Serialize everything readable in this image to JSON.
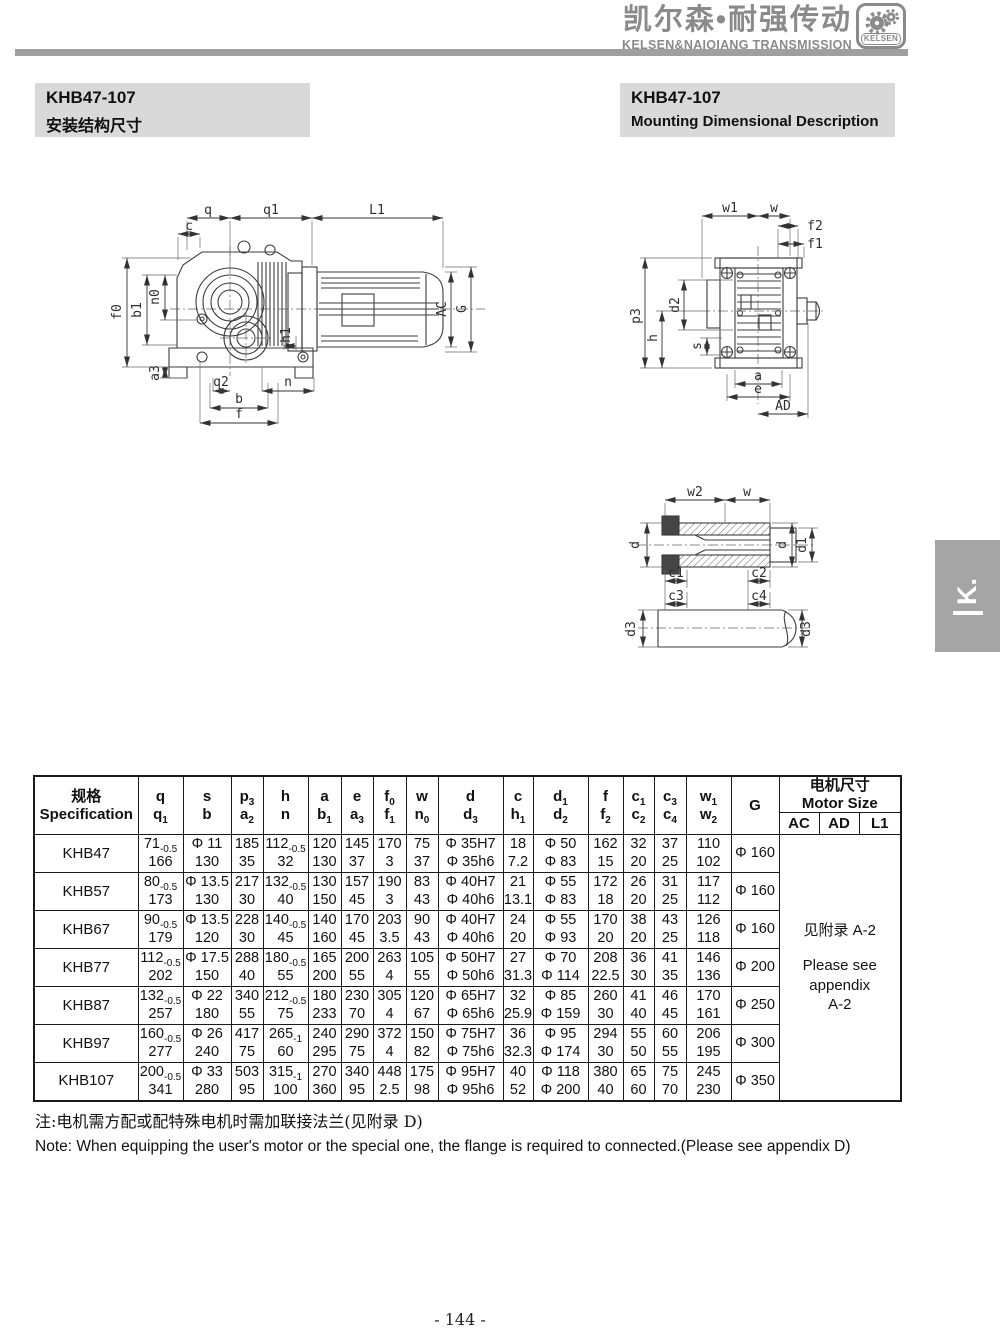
{
  "header": {
    "brand_cn": "凯尔森•耐强传动",
    "brand_en": "KELSEN&NAIQIANG TRANSMISSION",
    "logo_text": "KELSEN"
  },
  "title_left": {
    "model": "KHB47-107",
    "subtitle": "安装结构尺寸"
  },
  "title_right": {
    "model": "KHB47-107",
    "subtitle": "Mounting Dimensional Description"
  },
  "side_tab": {
    "label": "K."
  },
  "drawings": {
    "side_view": {
      "labels": {
        "q": "q",
        "q1": "q1",
        "L1": "L1",
        "c": "c",
        "f0": "f0",
        "b1": "b1",
        "n0": "n0",
        "a3": "a3",
        "q2": "q2",
        "n": "n",
        "b": "b",
        "f": "f",
        "h1": "h1",
        "AC": "AC",
        "G": "G"
      }
    },
    "end_view": {
      "labels": {
        "w1": "w1",
        "w": "w",
        "f2": "f2",
        "f1": "f1",
        "p3": "p3",
        "h": "h",
        "d2": "d2",
        "s": "s",
        "a": "a",
        "e": "e",
        "AD": "AD"
      }
    },
    "shaft_view": {
      "labels": {
        "w2": "w2",
        "w": "w",
        "d_left": "d",
        "d_right": "d",
        "d1": "d1",
        "c1": "c1",
        "c2": "c2",
        "c3": "c3",
        "c4": "c4",
        "d3_left": "d3",
        "d3_right": "d3"
      }
    }
  },
  "table": {
    "spec_header": {
      "cn": "规格",
      "en": "Specification"
    },
    "columns": [
      {
        "top": "q",
        "bottom": "q~1"
      },
      {
        "top": "s",
        "bottom": "b"
      },
      {
        "top": "p~3",
        "bottom": "a~2"
      },
      {
        "top": "h",
        "bottom": "n"
      },
      {
        "top": "a",
        "bottom": "b~1"
      },
      {
        "top": "e",
        "bottom": "a~3"
      },
      {
        "top": "f~0",
        "bottom": "f~1"
      },
      {
        "top": "w",
        "bottom": "n~0"
      },
      {
        "top": "d",
        "bottom": "d~3"
      },
      {
        "top": "c",
        "bottom": "h~1"
      },
      {
        "top": "d~1",
        "bottom": "d~2"
      },
      {
        "top": "f",
        "bottom": "f~2"
      },
      {
        "top": "c~1",
        "bottom": "c~2"
      },
      {
        "top": "c~3",
        "bottom": "c~4"
      },
      {
        "top": "w~1",
        "bottom": "w~2"
      },
      {
        "top": "G",
        "bottom": ""
      }
    ],
    "motor_header": {
      "cn": "电机尺寸",
      "en": "Motor Size",
      "sub": [
        "AC",
        "AD",
        "L1"
      ]
    },
    "rows": [
      {
        "model": "KHB47",
        "cells": [
          [
            "71~-0.5",
            "166"
          ],
          [
            "Φ 11",
            "130"
          ],
          [
            "185",
            "35"
          ],
          [
            "112~-0.5",
            "32"
          ],
          [
            "120",
            "130"
          ],
          [
            "145",
            "37"
          ],
          [
            "170",
            "3"
          ],
          [
            "75",
            "37"
          ],
          [
            "Φ 35H7",
            "Φ 35h6"
          ],
          [
            "18",
            "7.2"
          ],
          [
            "Φ 50",
            "Φ 83"
          ],
          [
            "162",
            "15"
          ],
          [
            "32",
            "20"
          ],
          [
            "37",
            "25"
          ],
          [
            "110",
            "102"
          ],
          [
            "Φ 160",
            ""
          ]
        ]
      },
      {
        "model": "KHB57",
        "cells": [
          [
            "80~-0.5",
            "173"
          ],
          [
            "Φ 13.5",
            "130"
          ],
          [
            "217",
            "30"
          ],
          [
            "132~-0.5",
            "40"
          ],
          [
            "130",
            "150"
          ],
          [
            "157",
            "45"
          ],
          [
            "190",
            "3"
          ],
          [
            "83",
            "43"
          ],
          [
            "Φ 40H7",
            "Φ 40h6"
          ],
          [
            "21",
            "13.1"
          ],
          [
            "Φ 55",
            "Φ 83"
          ],
          [
            "172",
            "18"
          ],
          [
            "26",
            "20"
          ],
          [
            "31",
            "25"
          ],
          [
            "117",
            "112"
          ],
          [
            "Φ 160",
            ""
          ]
        ]
      },
      {
        "model": "KHB67",
        "cells": [
          [
            "90~-0.5",
            "179"
          ],
          [
            "Φ 13.5",
            "120"
          ],
          [
            "228",
            "30"
          ],
          [
            "140~-0.5",
            "45"
          ],
          [
            "140",
            "160"
          ],
          [
            "170",
            "45"
          ],
          [
            "203",
            "3.5"
          ],
          [
            "90",
            "43"
          ],
          [
            "Φ 40H7",
            "Φ 40h6"
          ],
          [
            "24",
            "20"
          ],
          [
            "Φ 55",
            "Φ 93"
          ],
          [
            "170",
            "20"
          ],
          [
            "38",
            "20"
          ],
          [
            "43",
            "25"
          ],
          [
            "126",
            "118"
          ],
          [
            "Φ 160",
            ""
          ]
        ]
      },
      {
        "model": "KHB77",
        "cells": [
          [
            "112~-0.5",
            "202"
          ],
          [
            "Φ 17.5",
            "150"
          ],
          [
            "288",
            "40"
          ],
          [
            "180~-0.5",
            "55"
          ],
          [
            "165",
            "200"
          ],
          [
            "200",
            "55"
          ],
          [
            "263",
            "4"
          ],
          [
            "105",
            "55"
          ],
          [
            "Φ 50H7",
            "Φ 50h6"
          ],
          [
            "27",
            "31.3"
          ],
          [
            "Φ 70",
            "Φ 114"
          ],
          [
            "208",
            "22.5"
          ],
          [
            "36",
            "30"
          ],
          [
            "41",
            "35"
          ],
          [
            "146",
            "136"
          ],
          [
            "Φ 200",
            ""
          ]
        ]
      },
      {
        "model": "KHB87",
        "cells": [
          [
            "132~-0.5",
            "257"
          ],
          [
            "Φ 22",
            "180"
          ],
          [
            "340",
            "55"
          ],
          [
            "212~-0.5",
            "75"
          ],
          [
            "180",
            "233"
          ],
          [
            "230",
            "70"
          ],
          [
            "305",
            "4"
          ],
          [
            "120",
            "67"
          ],
          [
            "Φ 65H7",
            "Φ 65h6"
          ],
          [
            "32",
            "25.9"
          ],
          [
            "Φ 85",
            "Φ 159"
          ],
          [
            "260",
            "30"
          ],
          [
            "41",
            "40"
          ],
          [
            "46",
            "45"
          ],
          [
            "170",
            "161"
          ],
          [
            "Φ 250",
            ""
          ]
        ]
      },
      {
        "model": "KHB97",
        "cells": [
          [
            "160~-0.5",
            "277"
          ],
          [
            "Φ 26",
            "240"
          ],
          [
            "417",
            "75"
          ],
          [
            "265~-1",
            "60"
          ],
          [
            "240",
            "295"
          ],
          [
            "290",
            "75"
          ],
          [
            "372",
            "4"
          ],
          [
            "150",
            "82"
          ],
          [
            "Φ 75H7",
            "Φ 75h6"
          ],
          [
            "36",
            "32.3"
          ],
          [
            "Φ 95",
            "Φ 174"
          ],
          [
            "294",
            "30"
          ],
          [
            "55",
            "50"
          ],
          [
            "60",
            "55"
          ],
          [
            "206",
            "195"
          ],
          [
            "Φ 300",
            ""
          ]
        ]
      },
      {
        "model": "KHB107",
        "cells": [
          [
            "200~-0.5",
            "341"
          ],
          [
            "Φ 33",
            "280"
          ],
          [
            "503",
            "95"
          ],
          [
            "315~-1",
            "100"
          ],
          [
            "270",
            "360"
          ],
          [
            "340",
            "95"
          ],
          [
            "448",
            "2.5"
          ],
          [
            "175",
            "98"
          ],
          [
            "Φ 95H7",
            "Φ 95h6"
          ],
          [
            "40",
            "52"
          ],
          [
            "Φ 118",
            "Φ 200"
          ],
          [
            "380",
            "40"
          ],
          [
            "65",
            "60"
          ],
          [
            "75",
            "70"
          ],
          [
            "245",
            "230"
          ],
          [
            "Φ 350",
            ""
          ]
        ]
      }
    ],
    "motor_cell": {
      "cn": "见附录 A-2",
      "en_lines": [
        "Please see",
        "appendix",
        "A-2"
      ]
    }
  },
  "notes": {
    "cn": "注:电机需方配或配特殊电机时需加联接法兰(见附录 D)",
    "en": "Note: When equipping the user's motor or the special one, the flange is required to connected.(Please see appendix D)"
  },
  "page": {
    "number": "- 144 -"
  }
}
